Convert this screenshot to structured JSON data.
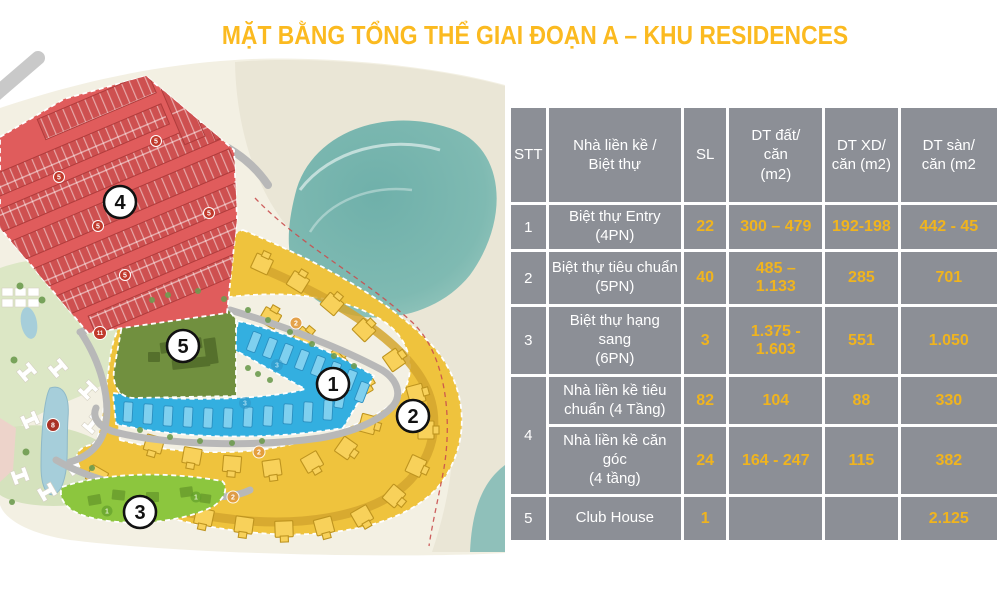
{
  "title": "MẶT BẰNG TỔNG THỂ GIAI ĐOẠN A – KHU RESIDENCES",
  "title_color": "#FBBA20",
  "map": {
    "zone_markers": [
      {
        "id": "zone-1-blue-townhouses",
        "label": "1"
      },
      {
        "id": "zone-2-yellow-villas",
        "label": "2"
      },
      {
        "id": "zone-3-green-strip",
        "label": "3"
      },
      {
        "id": "zone-4-red-townhouses",
        "label": "4"
      },
      {
        "id": "zone-5-clubhouse",
        "label": "5"
      }
    ],
    "minor_markers": [
      {
        "label": "5"
      },
      {
        "label": "5"
      },
      {
        "label": "5"
      },
      {
        "label": "5"
      },
      {
        "label": "5"
      },
      {
        "label": "11"
      },
      {
        "label": "8"
      },
      {
        "label": "2"
      },
      {
        "label": "2"
      },
      {
        "label": "2"
      },
      {
        "label": "3"
      },
      {
        "label": "3"
      },
      {
        "label": "1"
      },
      {
        "label": "1"
      }
    ],
    "colors": {
      "zone1_blue": "#33AFE0",
      "zone2_yellow": "#EFC33D",
      "zone3_green": "#8CC63E",
      "zone4_red": "#E05C5C",
      "zone5_olive": "#71903F",
      "sea": "#79B7B1",
      "sand": "#EAE6D6"
    }
  },
  "table": {
    "style": {
      "cell_bg": "#8C8F96",
      "number_color": "#F0B41E",
      "header_text_color": "#FFFFFF"
    },
    "header": {
      "stt": "STT",
      "name": "Nhà liền kề /\nBiệt thự",
      "sl": "SL",
      "dt_dat": "DT đất/\ncăn\n(m2)",
      "dt_xd": "DT XD/\ncăn (m2)",
      "dt_san": "DT sàn/\ncăn (m2"
    },
    "rows": [
      {
        "stt": "1",
        "name": "Biệt thự Entry\n(4PN)",
        "sl": "22",
        "dt_dat": "300 – 479",
        "dt_xd": "192-198",
        "dt_san": "442 - 45"
      },
      {
        "stt": "2",
        "name": "Biệt thự tiêu chuẩn\n(5PN)",
        "sl": "40",
        "dt_dat": "485 –\n1.133",
        "dt_xd": "285",
        "dt_san": "701"
      },
      {
        "stt": "3",
        "name": "Biệt thự hạng\nsang\n(6PN)",
        "sl": "3",
        "dt_dat": "1.375 -\n1.603",
        "dt_xd": "551",
        "dt_san": "1.050"
      },
      {
        "stt": "4",
        "name": "Nhà liền kề tiêu\nchuẩn (4 Tầng)",
        "sl": "82",
        "dt_dat": "104",
        "dt_xd": "88",
        "dt_san": "330"
      },
      {
        "name": "Nhà liền kề căn\ngóc\n(4 tầng)",
        "sl": "24",
        "dt_dat": "164 - 247",
        "dt_xd": "115",
        "dt_san": "382"
      },
      {
        "stt": "5",
        "name": "Club House",
        "sl": "1",
        "dt_dat": "",
        "dt_xd": "",
        "dt_san": "2.125"
      }
    ]
  }
}
